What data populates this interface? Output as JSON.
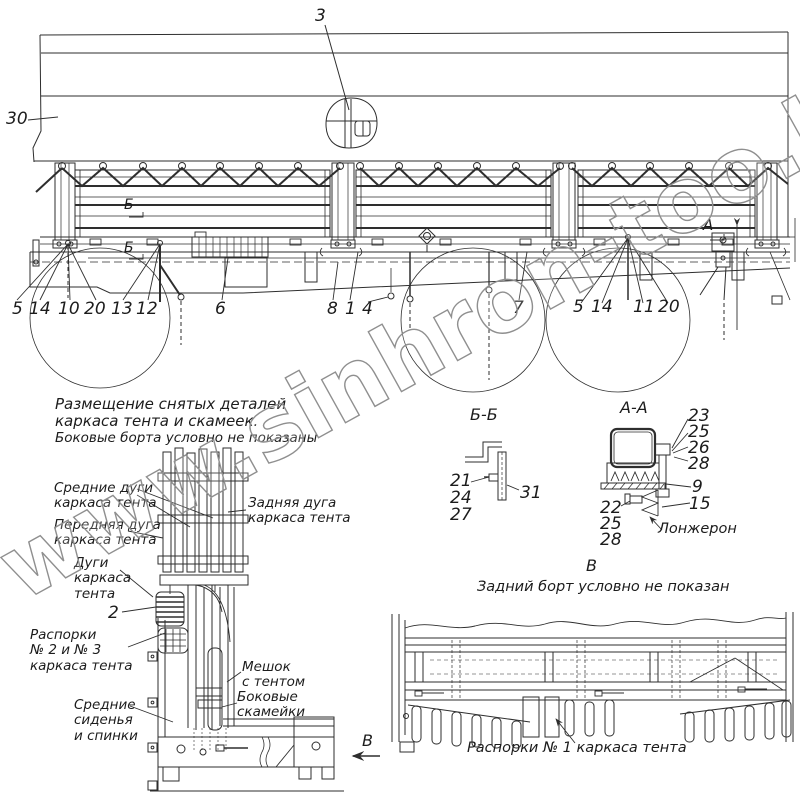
{
  "watermark": "www.sinhron-too.kz",
  "main_view": {
    "n3": "3",
    "n30": "30",
    "n5a": "5",
    "n14a": "14",
    "n10": "10",
    "n20a": "20",
    "n13": "13",
    "n12": "12",
    "n6": "6",
    "n8": "8",
    "n1": "1",
    "n4": "4",
    "n7": "7",
    "n5b": "5",
    "n14b": "14",
    "n11": "11",
    "n20b": "20",
    "section_b": "Б",
    "section_a": "А"
  },
  "storage_view": {
    "title": "Размещение снятых деталей\nкаркаса тента и скамеек.",
    "note": "Боковые борта условно не показаны",
    "label_middle_bows": "Средние дуги\nкаркаса тента",
    "label_rear_bow": "Задняя дуга\nкаркаса тента",
    "label_front_bow": "Передняя дуга\nкаркаса тента",
    "label_bows": "Дуги\nкаркаса\nтента",
    "n2": "2",
    "label_spacers": "Распорки\n№ 2 и № 3\nкаркаса тента",
    "label_bag": "Мешок\nс тентом",
    "label_side_benches": "Боковые\nскамейки",
    "label_middle_seats": "Средние\nсиденья\nи спинки",
    "view_arrow": "В"
  },
  "section_bb": {
    "title": "Б-Б",
    "n21": "21",
    "n24": "24",
    "n27": "27",
    "n31": "31"
  },
  "section_aa": {
    "title": "А-А",
    "n23": "23",
    "n25a": "25",
    "n26": "26",
    "n28a": "28",
    "n9": "9",
    "n15": "15",
    "n22": "22",
    "n25b": "25",
    "n28b": "28",
    "longeron": "Лонжерон"
  },
  "view_v": {
    "title": "В",
    "note": "Задний борт условно не показан",
    "caption": "Распорки № 1 каркаса тента"
  }
}
